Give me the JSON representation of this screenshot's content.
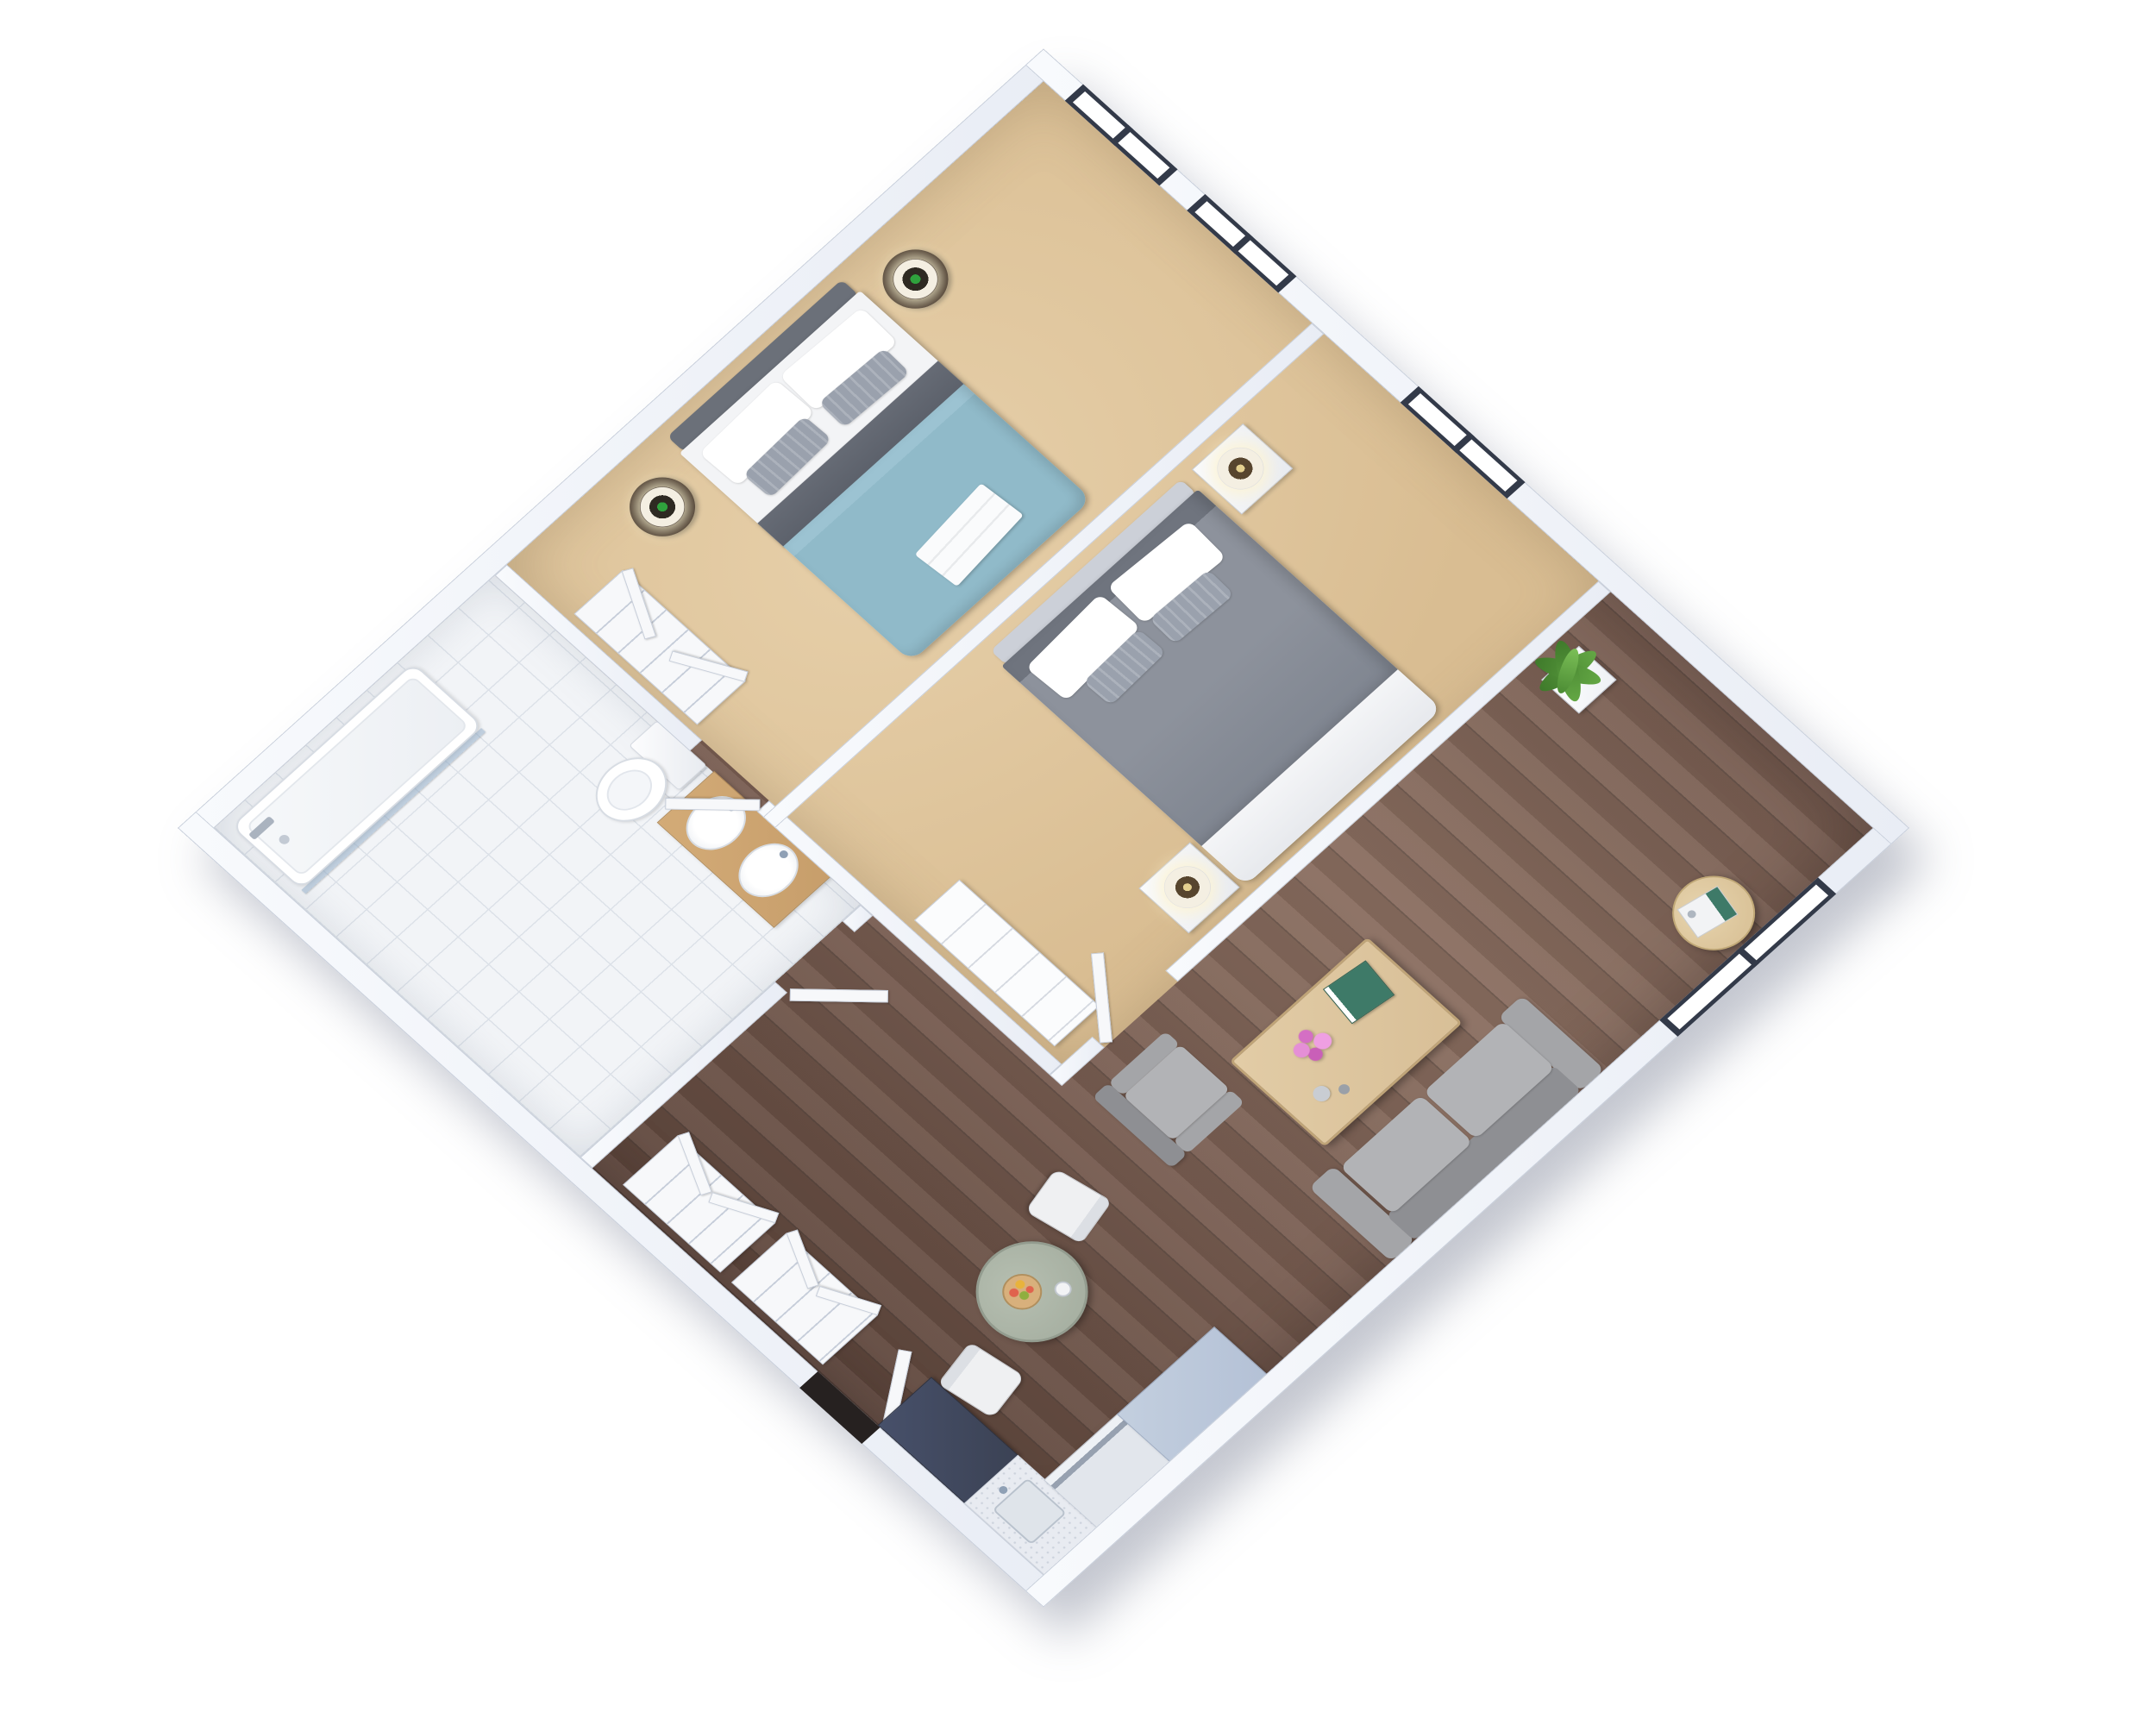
{
  "scene": {
    "description": "3D isometric floor plan render of a small apartment, viewed from above and rotated 45 degrees",
    "background": "#ffffff",
    "rooms_count": 7,
    "window_count": 4
  },
  "palette": {
    "wall": "#e9edf5",
    "wallHi": "#f8fafd",
    "wallEdge": "#c7ceda",
    "carpet": "#d9bd92",
    "carpetHi": "#e7d0aa",
    "wood": "#785d51",
    "woodDark": "#5e463c",
    "woodHi": "#8a6e60",
    "tile": "#f2f4f7",
    "tileLine": "#dce1e8",
    "frame": "#333a49",
    "glass": "#ffffff",
    "duvetBlue": "#90bac9",
    "throwDark": "#5c616b",
    "headboard": "#6b7079",
    "bedWhite": "#f3f4f6",
    "pillowGray": "#9aa1ad",
    "duvetGray": "#878c96",
    "duvetGrayDark": "#6f747e",
    "headboard2": "#ccd0d8",
    "sofa": "#a4a5a8",
    "sofaDark": "#8e8f93",
    "sofaHi": "#b2b3b6",
    "tableWood": "#d8bf97",
    "tableWoodEdge": "#bfa478",
    "sideWood": "#dbc49a",
    "tableGreen": "#a8b1a3",
    "tableGreenEdge": "#939c8f",
    "chairWhite": "#eff0f2",
    "counterDark": "#3b4254",
    "cabinetBlue": "#b4c1d6",
    "counterLight": "#e8ebf1",
    "steel": "#97a1b0",
    "nightDark": "#39291f",
    "lampShade": "#f4efe2",
    "lampGreen": "#2fa23d",
    "lampDark": "#2e2a22",
    "lampWarm": "#e3cf8f",
    "plantGreen": "#4c8c34",
    "planter": "#eef1f5",
    "vanityWood": "#c79e6b",
    "pink": "#e084cf",
    "teal": "#3e7a68",
    "doorDark": "#262120",
    "white": "#f7f8fa"
  },
  "rooms": {
    "bedroom1": {
      "label": "Bedroom 1",
      "floor": "beige carpet",
      "windows": 2
    },
    "bedroom2": {
      "label": "Bedroom 2",
      "floor": "beige carpet",
      "windows": 1
    },
    "bathroom": {
      "label": "Bathroom",
      "floor": "white tile",
      "windows": 0
    },
    "hallway": {
      "label": "Hallway with closets",
      "floor": "dark wood",
      "windows": 0
    },
    "living": {
      "label": "Living room",
      "floor": "dark wood",
      "windows": 1
    },
    "dining": {
      "label": "Dining area",
      "floor": "dark wood",
      "windows": 0
    },
    "kitchen": {
      "label": "Kitchen corner",
      "floor": "dark wood",
      "windows": 0
    }
  },
  "furniture": {
    "bed_blue": "Double bed with light blue duvet and dark throw",
    "bed_gray": "Double bed with gray duvet",
    "nightstand_round": "Round dark wood nightstand",
    "nightstand_white": "White block nightstand",
    "lamp_green": "White drum lamp with green base",
    "lamp_warm": "White drum lamp with warm bulb",
    "wardrobe": "Open shelving closet",
    "dresser": "White dresser",
    "tub": "Bathtub with shower screen",
    "shower": "Shower control",
    "toilet": "Toilet",
    "vanity": "Wood vanity with two oval sinks",
    "sofa": "Two-seat gray sofa",
    "armchair": "Gray armchair",
    "coffee_table": "Wood coffee table",
    "side_table": "Round wood side table with books",
    "dining_table": "Round sage-green dining table",
    "dining_chair": "White dining chair",
    "fruit_bowl": "Bowl of fruit",
    "candle": "Small candle",
    "plant": "Potted green plant",
    "counter_dark": "Dark kitchen counter / cooktop",
    "counter_sink": "Kitchen counter with sink",
    "dishwasher": "Dishwasher with steel handle",
    "cabinet": "Light blue kitchen cabinet",
    "entry_door": "Entry door opening",
    "interior_door": "Open interior door",
    "window": "Window with dark charcoal frame",
    "towel": "Folded towel at bed foot",
    "flowers": "Pink flower arrangement",
    "book": "Book with teal cover"
  }
}
